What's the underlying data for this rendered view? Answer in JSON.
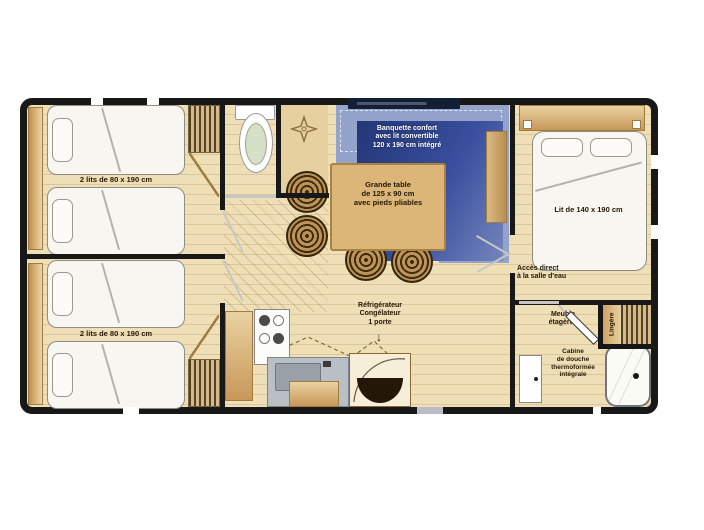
{
  "plan_title": "mobile-home floor plan",
  "colors": {
    "wall": "#181818",
    "floor": "#eedfb6",
    "floor_line": "#ddc69c",
    "wood_dark": "#c28f4e",
    "wood_light": "#ecd6a4",
    "table": "#dcb578",
    "banquette_light": "#93a3c9",
    "banquette_dark": "#2b3c85",
    "watermark_band": "#141f36",
    "label_text": "#241806"
  },
  "rooms": {
    "bedroom_top_left": {
      "label": "2 lits de 80 x 190 cm"
    },
    "bedroom_bottom_left": {
      "label": "2 lits de 80 x 190 cm"
    },
    "living": {
      "banquette": {
        "line1": "Banquette confort",
        "line2": "avec lit convertible",
        "line3": "120 x 190 cm intégré"
      },
      "table": {
        "line1": "Grande table",
        "line2": "de 125 x 90 cm",
        "line3": "avec pieds pliables"
      }
    },
    "kitchen": {
      "fridge": {
        "line1": "Réfrigérateur",
        "line2": "Congélateur",
        "line3": "1 porte"
      },
      "fridge_arrow": "↓"
    },
    "bedroom_right": {
      "label": "Lit de 140 x 190 cm",
      "access": {
        "line1": "Accès direct",
        "line2": "à la salle d'eau"
      }
    },
    "storage": {
      "shelves": {
        "line1": "Meuble",
        "line2": "étagères"
      },
      "linen": "Lingère"
    },
    "bathroom": {
      "shower": {
        "line1": "Cabine",
        "line2": "de douche",
        "line3": "thermoformée",
        "line4": "intégrale"
      }
    }
  }
}
